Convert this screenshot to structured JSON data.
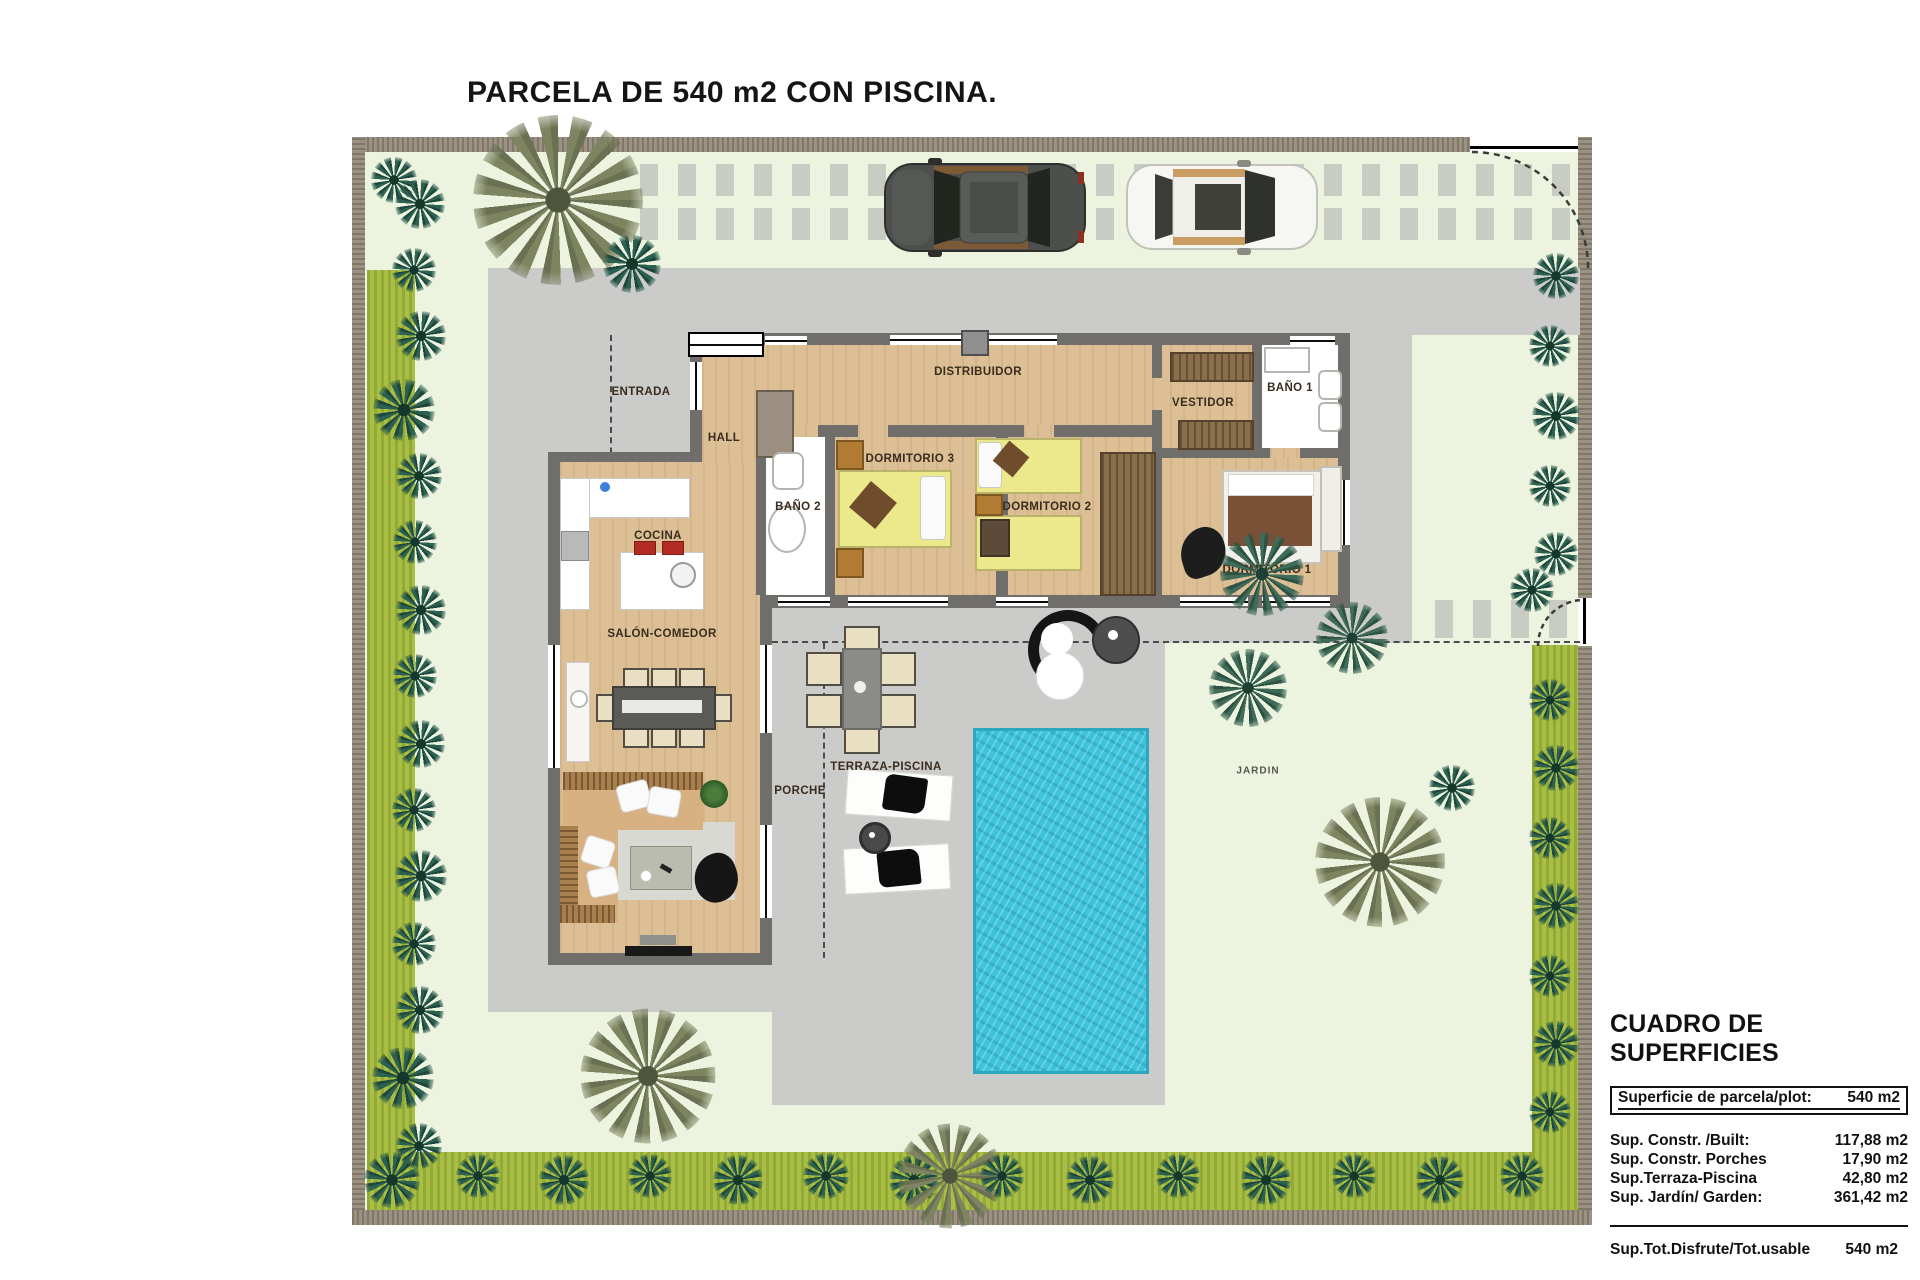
{
  "title": "PARCELA DE 540 m2 CON PISCINA.",
  "labels": {
    "entrada": "ENTRADA",
    "hall": "HALL",
    "distribuidor": "DISTRIBUIDOR",
    "bano2": "BAÑO 2",
    "dormitorio3": "DORMITORIO 3",
    "dormitorio2": "DORMITORIO 2",
    "vestidor": "VESTIDOR",
    "bano1": "BAÑO 1",
    "dormitorio1": "DORMITORIO 1",
    "cocina": "COCINA",
    "salon_comedor": "SALÓN-COMEDOR",
    "porche": "PORCHE",
    "terraza_piscina": "TERRAZA-PISCINA",
    "jardin": "JARDIN"
  },
  "summary_table": {
    "heading": "CUADRO DE SUPERFICIES",
    "plot_row": {
      "label": "Superficie de parcela/plot:",
      "value": "540 m2"
    },
    "rows": [
      {
        "label": "Sup. Constr. /Built:",
        "value": "117,88 m2"
      },
      {
        "label": "Sup. Constr. Porches",
        "value": "17,90 m2"
      },
      {
        "label": "Sup.Terraza-Piscina",
        "value": "42,80 m2"
      },
      {
        "label": "Sup. Jardín/ Garden:",
        "value": "361,42 m2"
      }
    ],
    "total_row": {
      "label": "Sup.Tot.Disfrute/Tot.usable",
      "value": "540 m2"
    }
  },
  "colors": {
    "pool": "#3ec3da",
    "garden": "#ecf3df",
    "hedge": "#a9bf44",
    "driveway": "#cbcbca",
    "wood_floor": "#dcbf95",
    "house_wall": "#6f6e6a",
    "boundary_wall": "#9b9284"
  }
}
